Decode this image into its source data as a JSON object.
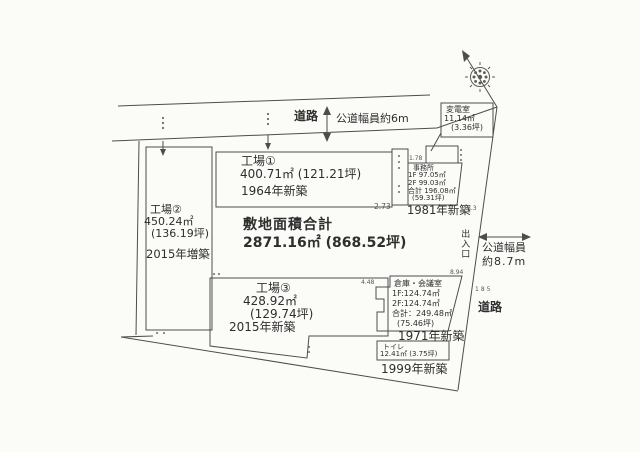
{
  "accent_ink": "#4d4d4d",
  "paper": "#fbfbf8",
  "roads": {
    "top": {
      "label": "道路",
      "width_note": "公道幅員約6m"
    },
    "right": {
      "label": "道路",
      "width_note_line1": "公道幅員",
      "width_note_line2": "約8.7m"
    }
  },
  "entrance": {
    "label": "出入口"
  },
  "site": {
    "total_label": "敷地面積合計",
    "total_value": "2871.16㎡ (868.52坪)"
  },
  "buildings": {
    "factory1": {
      "name": "工場①",
      "area": "400.71㎡ (121.21坪)",
      "built": "1964年新築"
    },
    "factory2": {
      "name": "工場②",
      "area": "450.24㎡",
      "tsubo": "(136.19坪)",
      "built": "2015年増築"
    },
    "factory3": {
      "name": "工場③",
      "area": "428.92㎡",
      "tsubo": "(129.74坪)",
      "built": "2015年新築"
    },
    "substation": {
      "name": "変電室",
      "area": "11.14㎡",
      "tsubo": "(3.36坪)"
    },
    "office": {
      "name": "事務所",
      "floor1": "1F 97.05㎡",
      "floor2": "2F 99.03㎡",
      "total": "合計 196.08㎡",
      "tsubo": "(59.31坪)",
      "built": "1981年新築"
    },
    "warehouse": {
      "name": "倉庫・会議室",
      "floor1": "1F:124.74㎡",
      "floor2": "2F:124.74㎡",
      "total": "合計：249.48㎡",
      "tsubo": "(75.46坪)",
      "built": "1971年新築"
    },
    "toilet": {
      "name": "トイレ",
      "area": "12.41㎡ (3.75坪)",
      "built": "1999年新築"
    }
  },
  "dimensions": {
    "d_178": "1.78",
    "d_273": "2.73",
    "d_894": "8.94",
    "d_448": "4.48",
    "d_185": "185",
    "d_83": "8.3"
  }
}
